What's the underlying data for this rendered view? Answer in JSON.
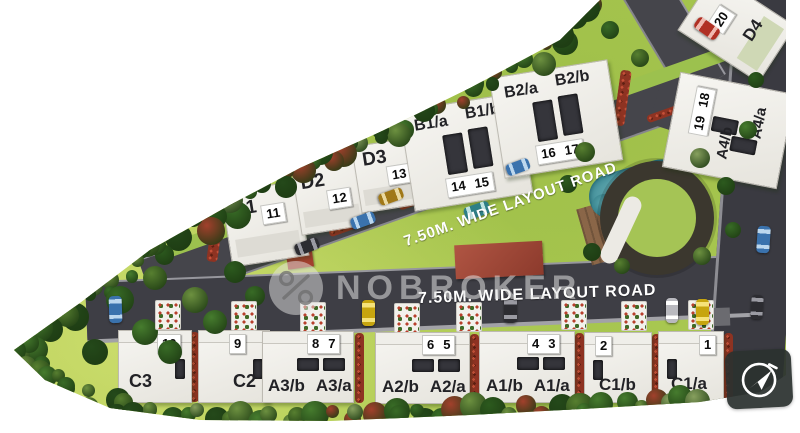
{
  "brand": {
    "watermark_text": "NOBROKER"
  },
  "icons": {
    "watermark_logo": "percent-circle-icon",
    "compass": "navigation-arrow-icon"
  },
  "roads": {
    "diagonal_label": "7.50M. WIDE LAYOUT ROAD",
    "horizontal_label": "7.50M. WIDE LAYOUT ROAD"
  },
  "plots": {
    "upper_row": [
      {
        "name": "D1",
        "labels": [
          "D1"
        ],
        "numbers": [
          "11"
        ]
      },
      {
        "name": "D2",
        "labels": [
          "D2"
        ],
        "numbers": [
          "12"
        ]
      },
      {
        "name": "D3",
        "labels": [
          "D3"
        ],
        "numbers": [
          "13"
        ]
      },
      {
        "name": "B1",
        "labels": [
          "B1/a",
          "B1/b"
        ],
        "numbers": [
          "14",
          "15"
        ]
      },
      {
        "name": "B2",
        "labels": [
          "B2/a",
          "B2/b"
        ],
        "numbers": [
          "16",
          "17"
        ]
      }
    ],
    "corner_plot": {
      "name": "D4",
      "labels": [
        "D4"
      ],
      "numbers": [
        "20"
      ]
    },
    "right_plot": {
      "name": "A4",
      "labels": [
        "A4/b",
        "A4/a"
      ],
      "numbers": [
        "19",
        "18"
      ]
    },
    "bottom_row": [
      {
        "name": "C3",
        "labels": [
          "C3"
        ],
        "numbers": [
          "10"
        ]
      },
      {
        "name": "C2",
        "labels": [
          "C2"
        ],
        "numbers": [
          "9"
        ]
      },
      {
        "name": "A3",
        "labels": [
          "A3/b",
          "A3/a"
        ],
        "numbers": [
          "8",
          "7"
        ]
      },
      {
        "name": "A2",
        "labels": [
          "A2/b",
          "A2/a"
        ],
        "numbers": [
          "6",
          "5"
        ]
      },
      {
        "name": "A1",
        "labels": [
          "A1/b",
          "A1/a"
        ],
        "numbers": [
          "4",
          "3"
        ]
      },
      {
        "name": "C1b",
        "labels": [
          "C1/b"
        ],
        "numbers": [
          "2"
        ]
      },
      {
        "name": "C1a",
        "labels": [
          "C1/a"
        ],
        "numbers": [
          "1"
        ]
      }
    ]
  },
  "colors": {
    "lawn": "#aecb52",
    "road": "#414147",
    "plot_white": "#f2f0ea",
    "pool_teal": "#2e7f8c",
    "hedge_red": "#a33d2a",
    "tree_green": "#3c6326",
    "watermark_gray": "#dedede"
  }
}
